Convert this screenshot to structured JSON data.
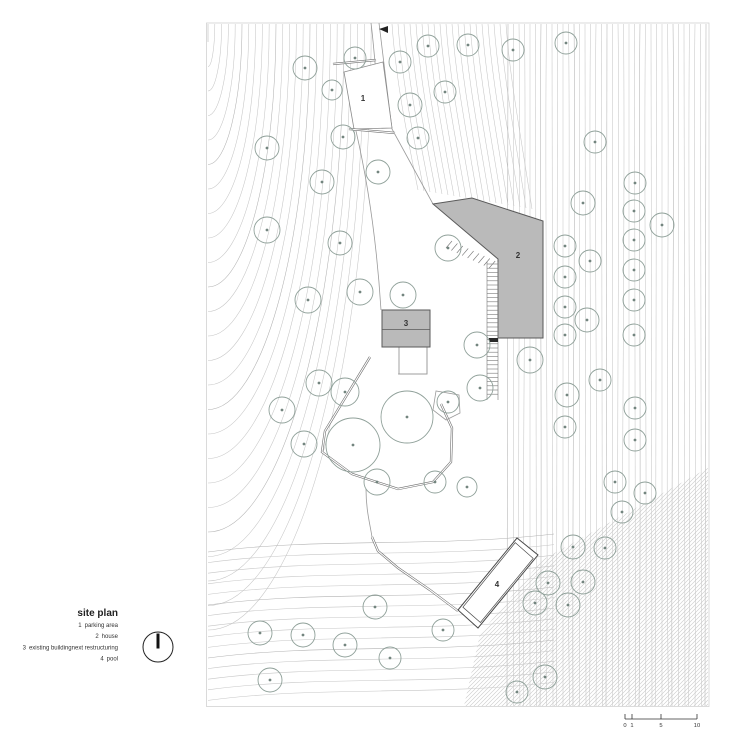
{
  "title": "site plan",
  "legend": [
    {
      "num": "1",
      "label": "parking area"
    },
    {
      "num": "2",
      "label": "house"
    },
    {
      "num": "3",
      "label": "existing buildingnext restructuring"
    },
    {
      "num": "4",
      "label": "pool"
    }
  ],
  "building_labels": [
    {
      "n": "1",
      "x": 363,
      "y": 101
    },
    {
      "n": "2",
      "x": 518,
      "y": 258
    },
    {
      "n": "3",
      "x": 406,
      "y": 326
    },
    {
      "n": "4",
      "x": 497,
      "y": 587
    }
  ],
  "scale_bar": {
    "ticks": [
      {
        "label": "0",
        "x": 625
      },
      {
        "label": "1",
        "x": 632
      },
      {
        "label": "5",
        "x": 661
      },
      {
        "label": "10",
        "x": 697
      }
    ]
  },
  "trees": [
    [
      305,
      68,
      12
    ],
    [
      355,
      58,
      11
    ],
    [
      400,
      62,
      11
    ],
    [
      428,
      46,
      11
    ],
    [
      468,
      45,
      11
    ],
    [
      513,
      50,
      11
    ],
    [
      566,
      43,
      11
    ],
    [
      445,
      92,
      11
    ],
    [
      410,
      105,
      12
    ],
    [
      332,
      90,
      10
    ],
    [
      343,
      137,
      12
    ],
    [
      418,
      138,
      11
    ],
    [
      267,
      148,
      12
    ],
    [
      595,
      142,
      11
    ],
    [
      322,
      182,
      12
    ],
    [
      378,
      172,
      12
    ],
    [
      267,
      230,
      13
    ],
    [
      340,
      243,
      12
    ],
    [
      448,
      248,
      13
    ],
    [
      583,
      203,
      12
    ],
    [
      635,
      183,
      11
    ],
    [
      634,
      211,
      11
    ],
    [
      662,
      225,
      12
    ],
    [
      565,
      246,
      11
    ],
    [
      590,
      261,
      11
    ],
    [
      565,
      277,
      11
    ],
    [
      634,
      240,
      11
    ],
    [
      634,
      270,
      11
    ],
    [
      308,
      300,
      13
    ],
    [
      360,
      292,
      13
    ],
    [
      403,
      295,
      13
    ],
    [
      565,
      307,
      11
    ],
    [
      587,
      320,
      12
    ],
    [
      565,
      335,
      11
    ],
    [
      634,
      300,
      11
    ],
    [
      634,
      335,
      11
    ],
    [
      477,
      345,
      13
    ],
    [
      530,
      360,
      13
    ],
    [
      480,
      388,
      13
    ],
    [
      319,
      383,
      13
    ],
    [
      345,
      392,
      14
    ],
    [
      282,
      410,
      13
    ],
    [
      304,
      444,
      13
    ],
    [
      377,
      482,
      13
    ],
    [
      353,
      445,
      27
    ],
    [
      407,
      417,
      26
    ],
    [
      448,
      402,
      11
    ],
    [
      435,
      482,
      11
    ],
    [
      467,
      487,
      10
    ],
    [
      567,
      395,
      12
    ],
    [
      600,
      380,
      11
    ],
    [
      565,
      427,
      11
    ],
    [
      635,
      408,
      11
    ],
    [
      635,
      440,
      11
    ],
    [
      615,
      482,
      11
    ],
    [
      645,
      493,
      11
    ],
    [
      622,
      512,
      11
    ],
    [
      573,
      547,
      12
    ],
    [
      605,
      548,
      11
    ],
    [
      548,
      583,
      12
    ],
    [
      583,
      582,
      12
    ],
    [
      535,
      603,
      12
    ],
    [
      568,
      605,
      12
    ],
    [
      375,
      607,
      12
    ],
    [
      443,
      630,
      11
    ],
    [
      390,
      658,
      11
    ],
    [
      345,
      645,
      12
    ],
    [
      260,
      633,
      12
    ],
    [
      303,
      635,
      12
    ],
    [
      270,
      680,
      12
    ],
    [
      545,
      677,
      12
    ],
    [
      517,
      692,
      11
    ]
  ],
  "colors": {
    "tree": "#8fa099",
    "tree_dot": "#73857f",
    "contour": "#c6c6c6",
    "contour_dark": "#b2b2b2",
    "building_fill": "#bababa",
    "building_edge": "#5a5a5a",
    "hatch": "#c9c9c9",
    "text": "#222222"
  }
}
